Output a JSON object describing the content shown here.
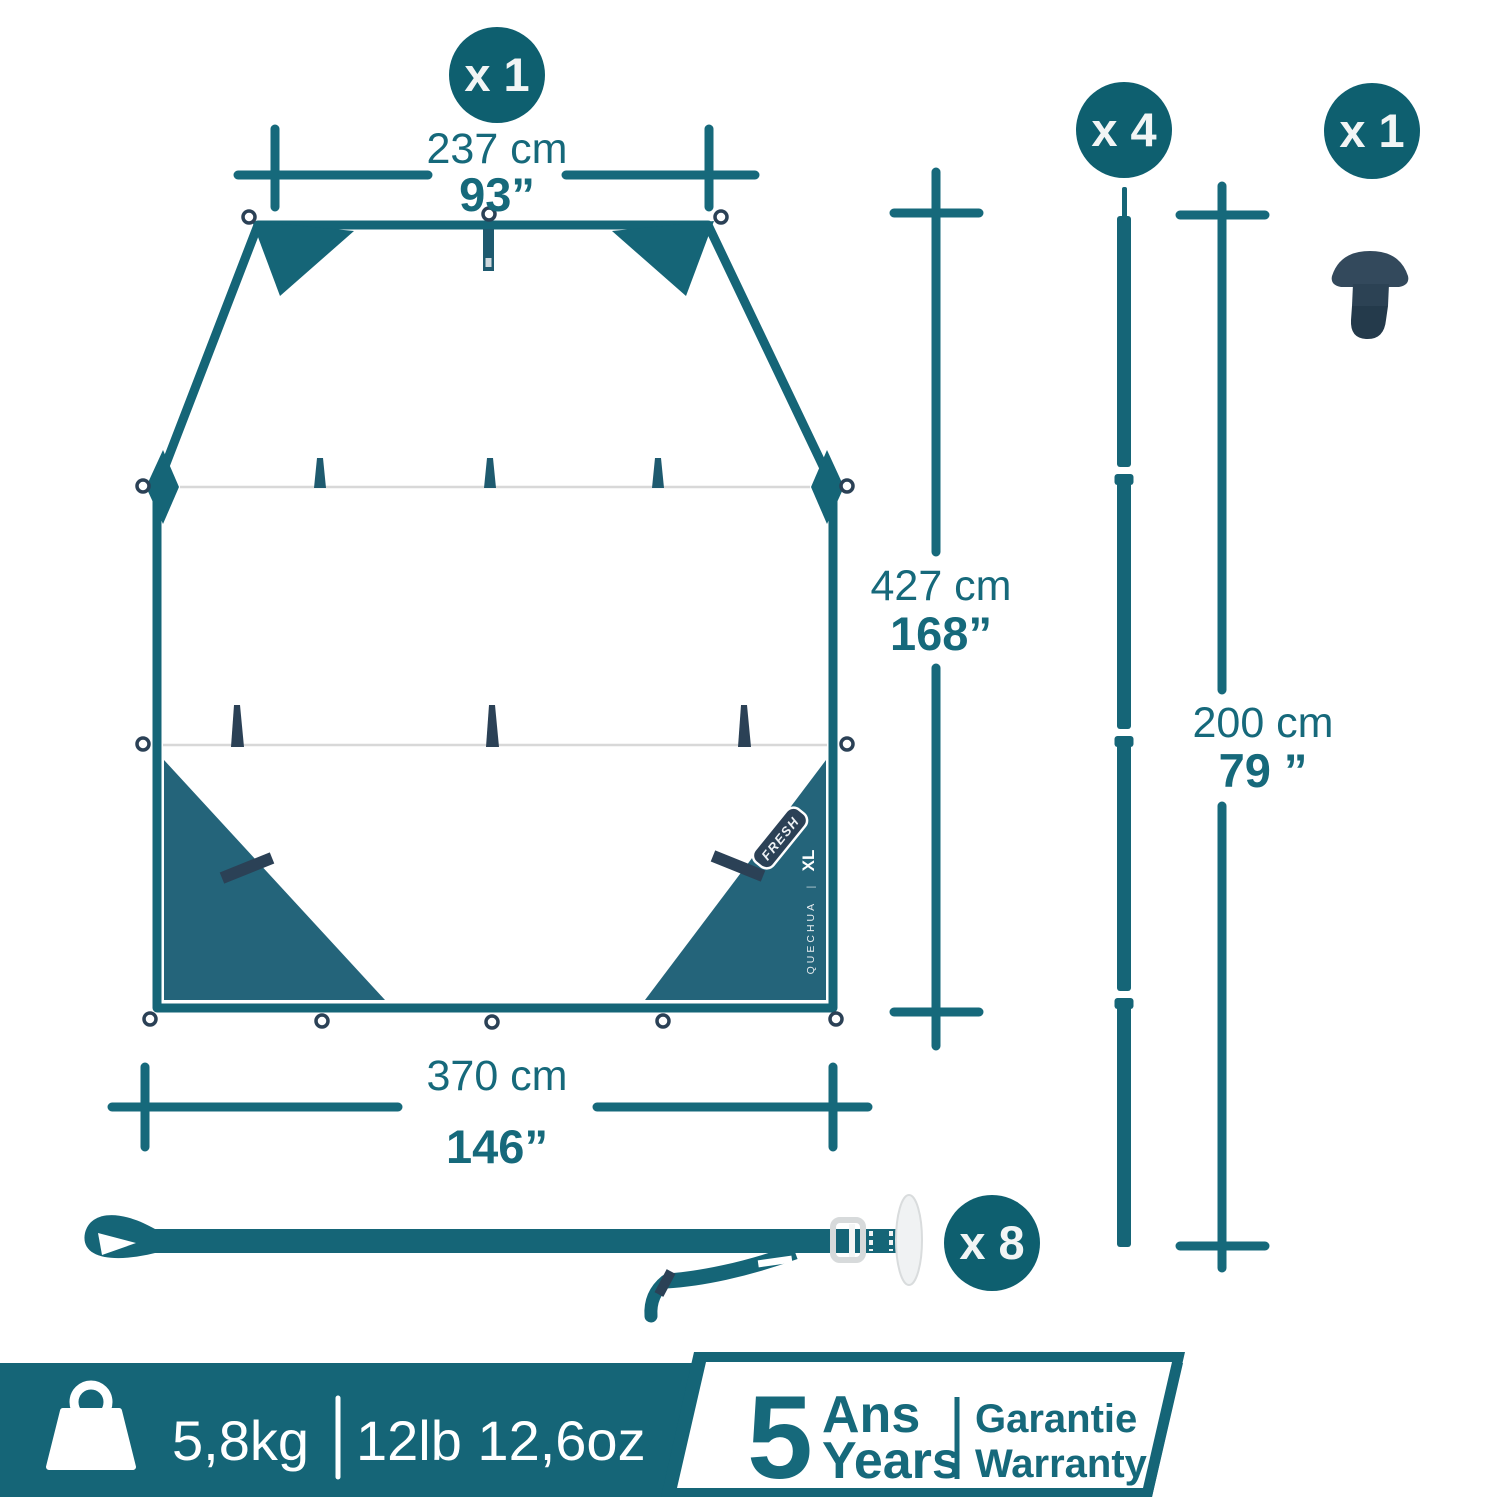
{
  "colors": {
    "teal": "#156577",
    "teal_text": "#16697B",
    "circle": "#0E5F6F",
    "triangle": "#24647A",
    "navy": "#2B4156",
    "slate": "#33495C",
    "seam": "#D8D8D8",
    "hardware_gray": "#D7DADB"
  },
  "tarp": {
    "count_badge": "x 1",
    "fresh_label": "FRESH",
    "brand": "QUECHUA",
    "separator": "|",
    "size": "XL"
  },
  "dimensions": {
    "top_width": {
      "metric": "237 cm",
      "imperial": "93”"
    },
    "length": {
      "metric": "427 cm",
      "imperial": "168”"
    },
    "bottom_width": {
      "metric": "370 cm",
      "imperial": "146”"
    },
    "pole_height": {
      "metric": "200 cm",
      "imperial": "79 ”"
    }
  },
  "pole": {
    "count_badge": "x 4"
  },
  "peg": {
    "count_badge": "x 1"
  },
  "strap": {
    "count_badge": "x 8"
  },
  "banner": {
    "weight_metric": "5,8kg",
    "weight_imperial": "12lb 12,6oz",
    "warranty_years": "5",
    "warranty_fr": "Ans",
    "warranty_en": "Years",
    "guarantee_fr": "Garantie",
    "guarantee_en": "Warranty"
  }
}
